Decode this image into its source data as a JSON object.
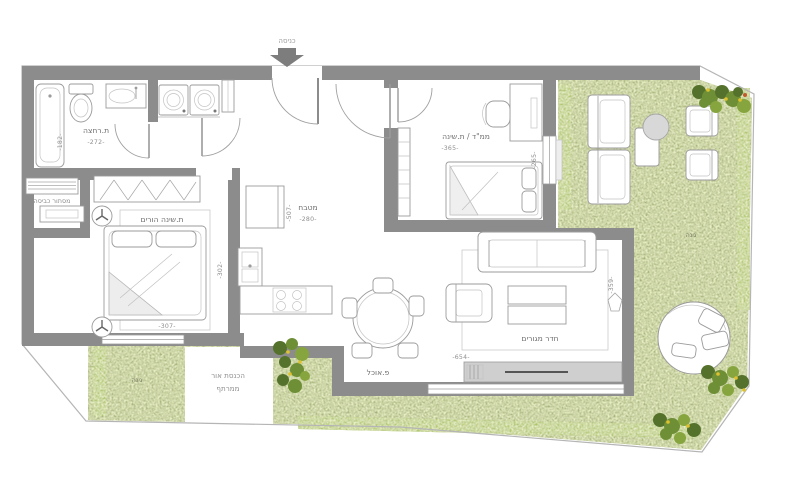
{
  "title": "apartment floor plan",
  "colors": {
    "wall": "#8c8c8c",
    "grass": "#9dab6b",
    "hedge": "#a6c93d",
    "boundary": "#b5b5b5",
    "arrow": "#7d7d7d"
  },
  "labels": {
    "entrance": "כניסה",
    "dining": "פ.אוכל",
    "garden_left": "גינה",
    "garden_right": "גינה",
    "lightwell_line1": "הכנסת אור",
    "lightwell_line2": "ממרתף"
  },
  "rooms": {
    "bathroom": {
      "name": "ת.רחצה",
      "width": "-272-",
      "depth": "-182-"
    },
    "laundry": {
      "name": "מסתור כביסה"
    },
    "parents_bedroom": {
      "name": "ת.שינה הורים",
      "width": "-307-",
      "depth": "-302-"
    },
    "kitchen": {
      "name": "מטבח",
      "width": "-280-",
      "depth": "-507-"
    },
    "safe_room": {
      "name": "ממ\"ד / ת.שינה",
      "width": "-365-",
      "depth": "-265-"
    },
    "living_room": {
      "name": "חדר מגורים",
      "width": "-654-",
      "depth": "-359-"
    }
  }
}
